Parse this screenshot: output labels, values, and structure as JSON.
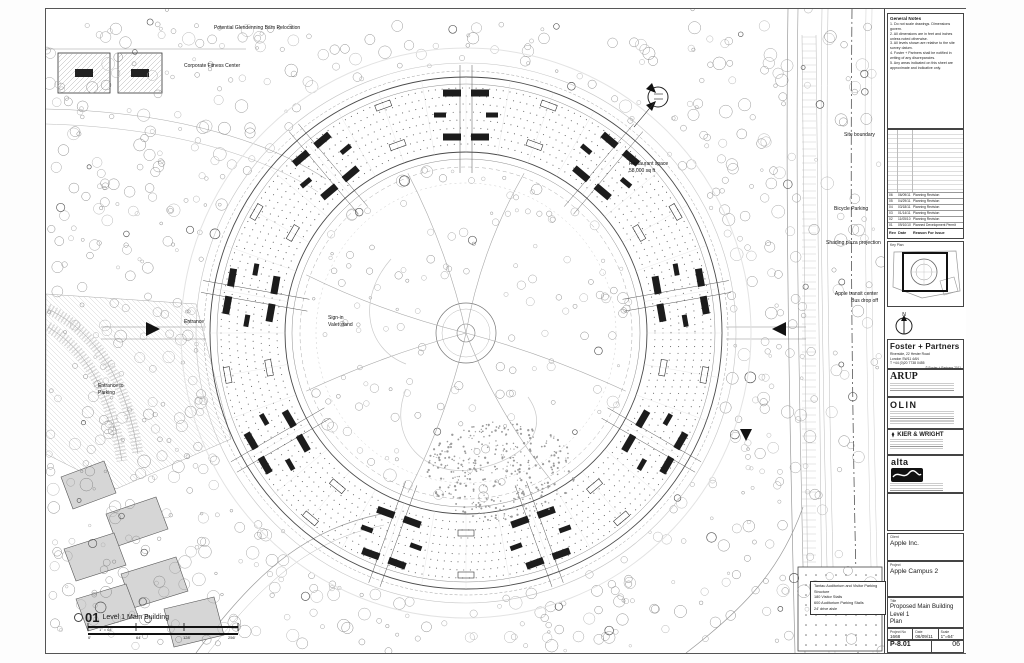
{
  "sheet": {
    "notes_title": "General Notes",
    "notes": [
      "1. Do not scale drawings. Dimensions govern.",
      "2. All dimensions are in feet and inches unless noted otherwise.",
      "3. All levels shown are relative to the site survey datum.",
      "4. Foster + Partners shall be notified in writing of any discrepancies.",
      "5. Any areas indicated on this sheet are approximate and indicative only."
    ],
    "revisions": {
      "header": [
        "Rev",
        "Date",
        "Reason For Issue"
      ],
      "rows": [
        [
          "06",
          "06/09/11",
          "Planning Revision"
        ],
        [
          "05",
          "04/29/11",
          "Planning Revision"
        ],
        [
          "04",
          "03/18/11",
          "Planning Revision"
        ],
        [
          "03",
          "01/14/11",
          "Planning Revision"
        ],
        [
          "02",
          "11/05/10",
          "Planning Revision"
        ],
        [
          "01",
          "09/10/10",
          "Planned Development Permit"
        ]
      ]
    },
    "key_plan_label": "Key Plan",
    "north_label": "N",
    "firms": {
      "foster": {
        "name": "Foster + Partners",
        "addr": "Riverside, 22 Hester Road\nLondon SW11 4AN\nT +44 (0)20 7738 0455",
        "copyright": "© Foster + Partners 2011"
      },
      "arup": "ARUP",
      "olin": "OLIN",
      "kier": "KIER & WRIGHT",
      "alta": "alta"
    },
    "client_label": "Client",
    "client": "Apple Inc.",
    "project_label": "Project",
    "project": "Apple Campus 2",
    "title_label": "Title",
    "title": "Proposed Main Building\nLevel 1\nPlan",
    "fields": {
      "project_no_label": "Project No",
      "project_no": "1668",
      "date_label": "Date",
      "date": "06/09/11",
      "scale_label": "Scale",
      "scale": "1\"=64'",
      "drawing_no_label": "Drawing No",
      "drawing_no": "P-8.01",
      "rev_label": "Rev",
      "rev": "06"
    }
  },
  "plan": {
    "labels": [
      {
        "text": "Potential Glendenning Barn Relocation"
      },
      {
        "text": "Corporate Fitness Center"
      },
      {
        "text": "Restaurant space\n58,000 sq ft"
      },
      {
        "text": "Site boundary"
      },
      {
        "text": "Bicycle Parking"
      },
      {
        "text": "Shading plaza projection"
      },
      {
        "text": "Apple transit center\nBus drop off"
      },
      {
        "text": "Entrance"
      },
      {
        "text": "Sign-in\nValet stand"
      },
      {
        "text": "Entrance to\nParking"
      }
    ],
    "parking_note": "Tantau Auditorium and Visitor Parking Structure\n180 Visitor Stalls\n600 Auditorium Parking Stalls\n24' drive aisle",
    "viewport": {
      "number": "01",
      "name": "Level 1 Main Building",
      "scale": "1\" = 64'"
    },
    "scale_bar": [
      "0'",
      "64'",
      "128'",
      "256'"
    ]
  }
}
